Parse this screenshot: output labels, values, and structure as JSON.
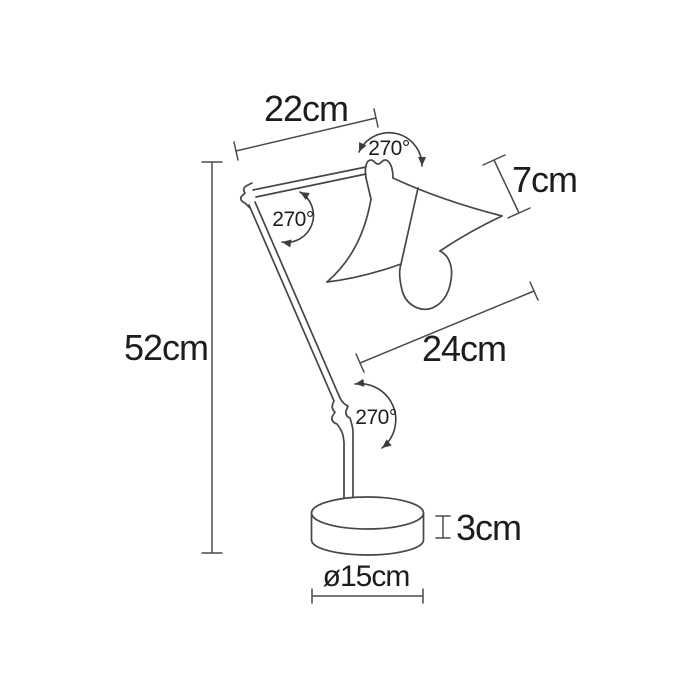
{
  "diagram": {
    "type": "technical-line-drawing",
    "subject": "articulated desk lamp side elevation with dimensions",
    "colors": {
      "background": "#ffffff",
      "line": "#474747",
      "text": "#1d1d1d"
    },
    "dimensions": [
      {
        "id": "upper-arm-length",
        "label": "22cm"
      },
      {
        "id": "total-height",
        "label": "52cm"
      },
      {
        "id": "shade-height",
        "label": "7cm"
      },
      {
        "id": "lower-arm-length",
        "label": "24cm"
      },
      {
        "id": "base-height",
        "label": "3cm"
      },
      {
        "id": "base-diameter",
        "label": "ø15cm"
      }
    ],
    "angles": [
      {
        "id": "head-joint-rotation",
        "label": "270°"
      },
      {
        "id": "elbow-joint-rotation",
        "label": "270°"
      },
      {
        "id": "base-joint-rotation",
        "label": "270°"
      }
    ]
  }
}
